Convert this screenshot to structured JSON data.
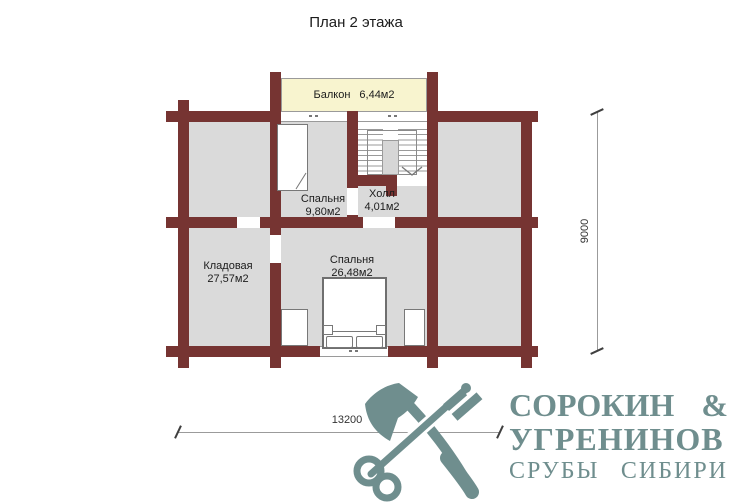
{
  "title": "План 2 этажа",
  "plan": {
    "rooms": [
      {
        "id": "balcony",
        "name": "Балкон",
        "area": "6,44м2"
      },
      {
        "id": "bedroom-small",
        "name": "Спальня",
        "area": "9,80м2"
      },
      {
        "id": "hall",
        "name": "Холл",
        "area": "4,01м2"
      },
      {
        "id": "storage",
        "name": "Кладовая",
        "area": "27,57м2"
      },
      {
        "id": "bedroom-large",
        "name": "Спальня",
        "area": "26,48м2"
      }
    ],
    "dimensions": {
      "horizontal": "13200",
      "vertical": "9000"
    }
  },
  "logo": {
    "icon": "crossed-axe-and-key-icon",
    "line1_left": "СОРОКИН",
    "line1_right": "&",
    "line2": "УГРЕНИНОВ",
    "tagline_word1": "СРУБЫ",
    "tagline_word2": "СИБИРИ"
  },
  "colors": {
    "wall": "#763432",
    "room_fill": "#dadada",
    "balcony_fill": "#f8f4cf",
    "logo": "#6f8e8e",
    "dimension_text": "#333333",
    "label_text": "#1c1c1c"
  }
}
